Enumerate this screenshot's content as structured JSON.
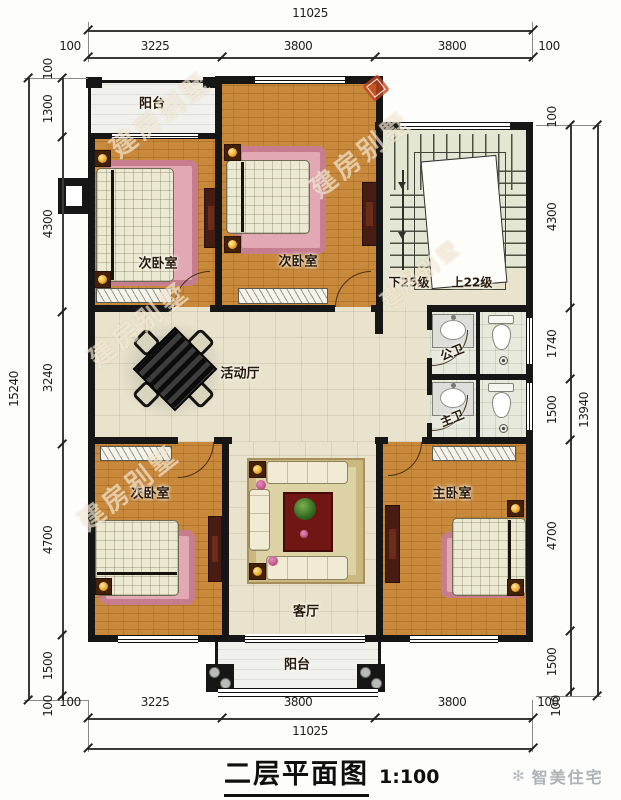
{
  "title": {
    "text": "二层平面图",
    "scale": "1:100"
  },
  "brand": {
    "icon": "sparkle-icon",
    "text": "智美住宅"
  },
  "watermark": {
    "text": "建房别墅"
  },
  "plan": {
    "rooms": {
      "balcony_top": "阳台",
      "bedroom_top_left": "次卧室",
      "bedroom_top_mid": "次卧室",
      "hall": "活动厅",
      "bath_public": "公卫",
      "bath_master": "主卫",
      "bedroom_bottom_left": "次卧室",
      "living_room": "客厅",
      "bedroom_master": "主卧室",
      "balcony_bottom": "阳台"
    },
    "stairs": {
      "down_label": "下25级",
      "up_label": "上22级"
    }
  },
  "dimensions": {
    "top": {
      "overall": "11025",
      "segments": [
        "100",
        "3225",
        "3800",
        "3800",
        "100"
      ]
    },
    "bottom": {
      "overall": "11025",
      "segments": [
        "100",
        "3225",
        "3800",
        "3800",
        "100"
      ]
    },
    "left": {
      "overall": "15240",
      "segments": [
        "100",
        "1300",
        "4300",
        "3240",
        "4700",
        "1500",
        "100"
      ]
    },
    "right": {
      "overall": "13940",
      "segments": [
        "100",
        "4300",
        "1740",
        "1500",
        "4700",
        "1500",
        "100"
      ]
    }
  },
  "colors": {
    "wall": "#161616",
    "wood_floor": "#c9893b",
    "tile_floor": "#e9e3cd",
    "stair_floor": "#e2e6d2",
    "rug_pink": "#c67e8e",
    "lamp_gold": "#eead2e"
  }
}
